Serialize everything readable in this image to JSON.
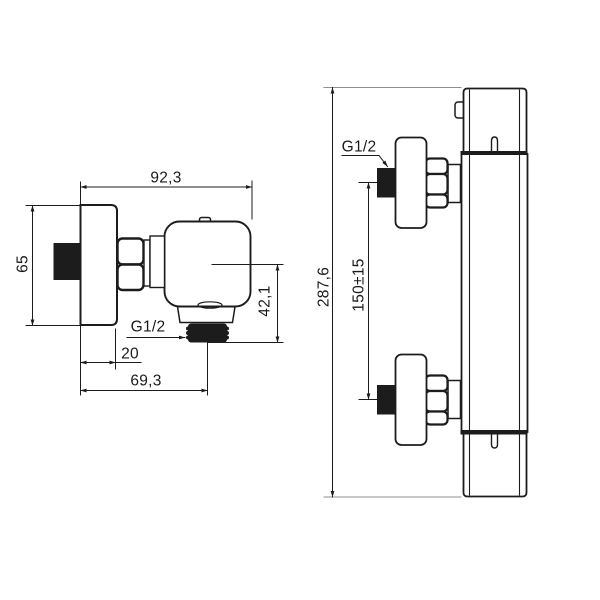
{
  "drawing": {
    "type": "technical-dimension-drawing",
    "subject": "thermostatic shower mixer - two orthographic views",
    "colors": {
      "background": "#ffffff",
      "line": "#1c1c1c",
      "ext_line": "#8f8f8f",
      "solid_fill": "#1c1c1c"
    },
    "side_view": {
      "dims": {
        "total_width": "92,3",
        "escutcheon_height": "65",
        "outlet_drop": "42,1",
        "thread": "G1/2",
        "escutcheon_depth": "20",
        "outlet_offset": "69,3"
      }
    },
    "front_view": {
      "dims": {
        "total_height": "287,6",
        "connection_spacing": "150±15",
        "thread": "G1/2"
      }
    }
  }
}
